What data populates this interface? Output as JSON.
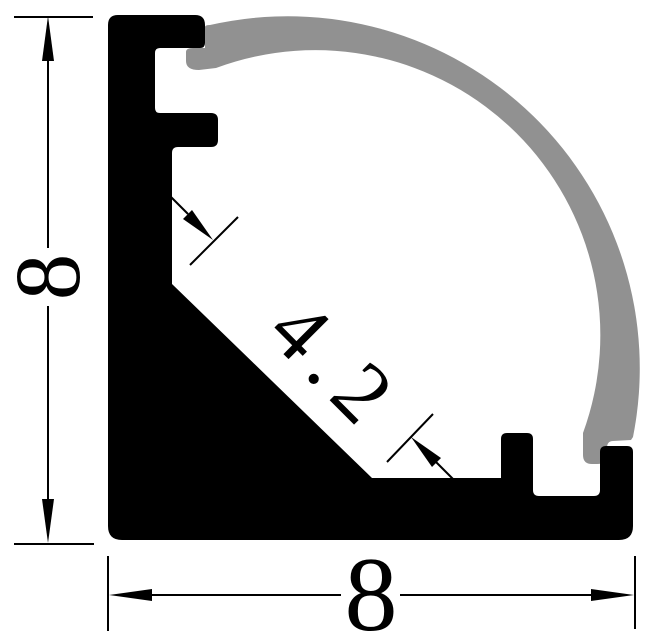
{
  "drawing": {
    "description": "Cross-section technical drawing of a corner LED aluminum profile with curved diffuser cover",
    "dimensions": {
      "height": {
        "value": "8"
      },
      "width": {
        "value": "8"
      },
      "face": {
        "value": "4.2"
      }
    },
    "colors": {
      "profile": "#000000",
      "cover": "#919191",
      "lines": "#000000",
      "background": "#ffffff"
    }
  }
}
